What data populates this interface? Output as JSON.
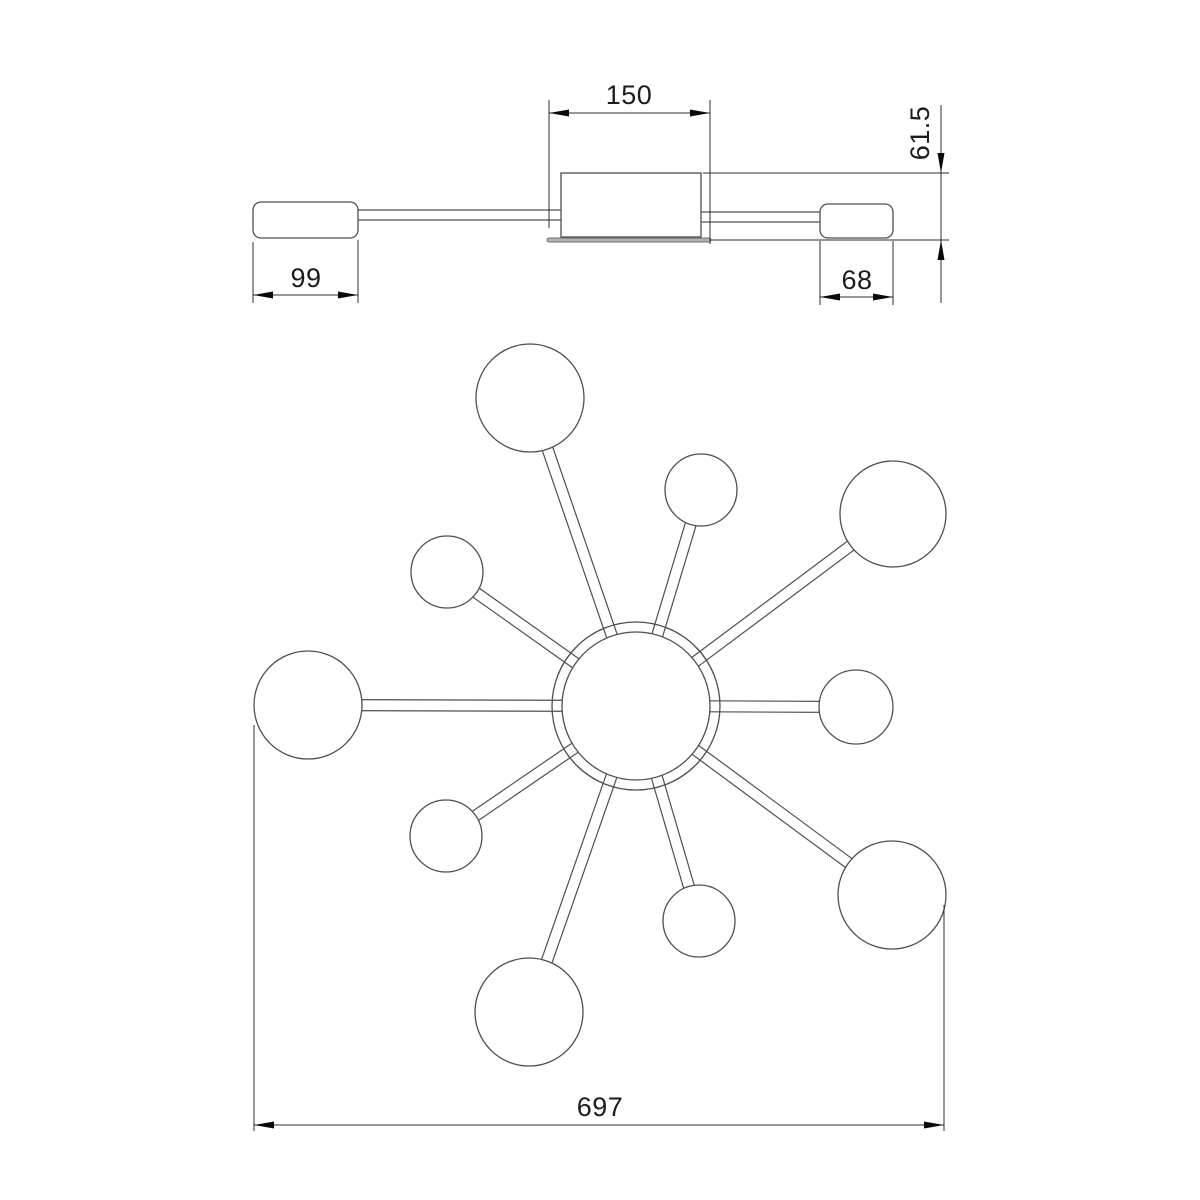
{
  "drawing": {
    "type": "technical-dimension-drawing",
    "colors": {
      "geometry": "#4f4f4f",
      "dimension": "#2e2e2e",
      "arrow": "#0a0a0a",
      "text": "#1c1c1c",
      "plate_fill": "#b3b3b3",
      "background": "#ffffff"
    },
    "side_view": {
      "left_cap": {
        "x": 253,
        "y": 202,
        "w": 105,
        "h": 36,
        "r": 8
      },
      "left_arm": {
        "x1": 358,
        "y_top": 210,
        "x2": 561,
        "y_bot": 220
      },
      "canopy": {
        "x": 561,
        "y": 173,
        "w": 140,
        "h": 64
      },
      "plate": {
        "x": 547,
        "y": 238,
        "w": 164,
        "h": 4,
        "r": 2
      },
      "right_arm": {
        "x1": 701,
        "y_top": 212,
        "x2": 820,
        "y_bot": 222
      },
      "right_cap": {
        "x": 820,
        "y": 204,
        "w": 73,
        "h": 34,
        "r": 8
      }
    },
    "plan_view": {
      "hub": {
        "cx": 636,
        "cy": 706,
        "r_outer": 84,
        "r_inner": 74
      },
      "arm_half_width": 5.5,
      "spheres": [
        {
          "cx": 530,
          "cy": 398,
          "r": 54
        },
        {
          "cx": 701,
          "cy": 490,
          "r": 36
        },
        {
          "cx": 893,
          "cy": 514,
          "r": 53
        },
        {
          "cx": 447,
          "cy": 572,
          "r": 36
        },
        {
          "cx": 308,
          "cy": 705,
          "r": 54
        },
        {
          "cx": 856,
          "cy": 707,
          "r": 37
        },
        {
          "cx": 446,
          "cy": 836,
          "r": 36
        },
        {
          "cx": 529,
          "cy": 1012,
          "r": 54
        },
        {
          "cx": 699,
          "cy": 921,
          "r": 36
        },
        {
          "cx": 892,
          "cy": 895,
          "r": 54
        }
      ]
    },
    "dims": [
      {
        "id": "canopy-width",
        "label": "150",
        "ext": [
          [
            549,
            100,
            549,
            228
          ],
          [
            710,
            100,
            710,
            244
          ]
        ],
        "line": [
          549,
          113,
          710,
          113
        ],
        "arrows": [
          [
            549,
            113,
            1,
            0
          ],
          [
            710,
            113,
            -1,
            0
          ]
        ],
        "text": {
          "x": 629,
          "y": 104,
          "rotate": 0
        }
      },
      {
        "id": "overall-height",
        "label": "61.5",
        "ext": [
          [
            703,
            173,
            949,
            173
          ],
          [
            711,
            240,
            949,
            240
          ]
        ],
        "line": [
          941,
          105,
          941,
          303
        ],
        "arrows": [
          [
            941,
            173,
            0,
            -1
          ],
          [
            941,
            240,
            0,
            1
          ]
        ],
        "text": {
          "x": 929,
          "y": 133,
          "rotate": -90
        }
      },
      {
        "id": "left-shade-width",
        "label": "99",
        "ext": [
          [
            253,
            242,
            253,
            303
          ],
          [
            358,
            240,
            358,
            303
          ]
        ],
        "line": [
          253,
          295,
          358,
          295
        ],
        "arrows": [
          [
            253,
            295,
            1,
            0
          ],
          [
            358,
            295,
            -1,
            0
          ]
        ],
        "text": {
          "x": 306,
          "y": 287,
          "rotate": 0
        }
      },
      {
        "id": "right-shade-width",
        "label": "68",
        "ext": [
          [
            820,
            241,
            820,
            305
          ],
          [
            893,
            241,
            893,
            305
          ]
        ],
        "line": [
          820,
          297,
          893,
          297
        ],
        "arrows": [
          [
            820,
            297,
            1,
            0
          ],
          [
            893,
            297,
            -1,
            0
          ]
        ],
        "text": {
          "x": 857,
          "y": 289,
          "rotate": 0
        }
      },
      {
        "id": "overall-diameter",
        "label": "697",
        "ext": [
          [
            254,
            725,
            254,
            1131
          ],
          [
            944,
            905,
            944,
            1131
          ]
        ],
        "line": [
          254,
          1125,
          944,
          1125
        ],
        "arrows": [
          [
            254,
            1125,
            1,
            0
          ],
          [
            944,
            1125,
            -1,
            0
          ]
        ],
        "text": {
          "x": 600,
          "y": 1116,
          "rotate": 0
        }
      }
    ]
  }
}
